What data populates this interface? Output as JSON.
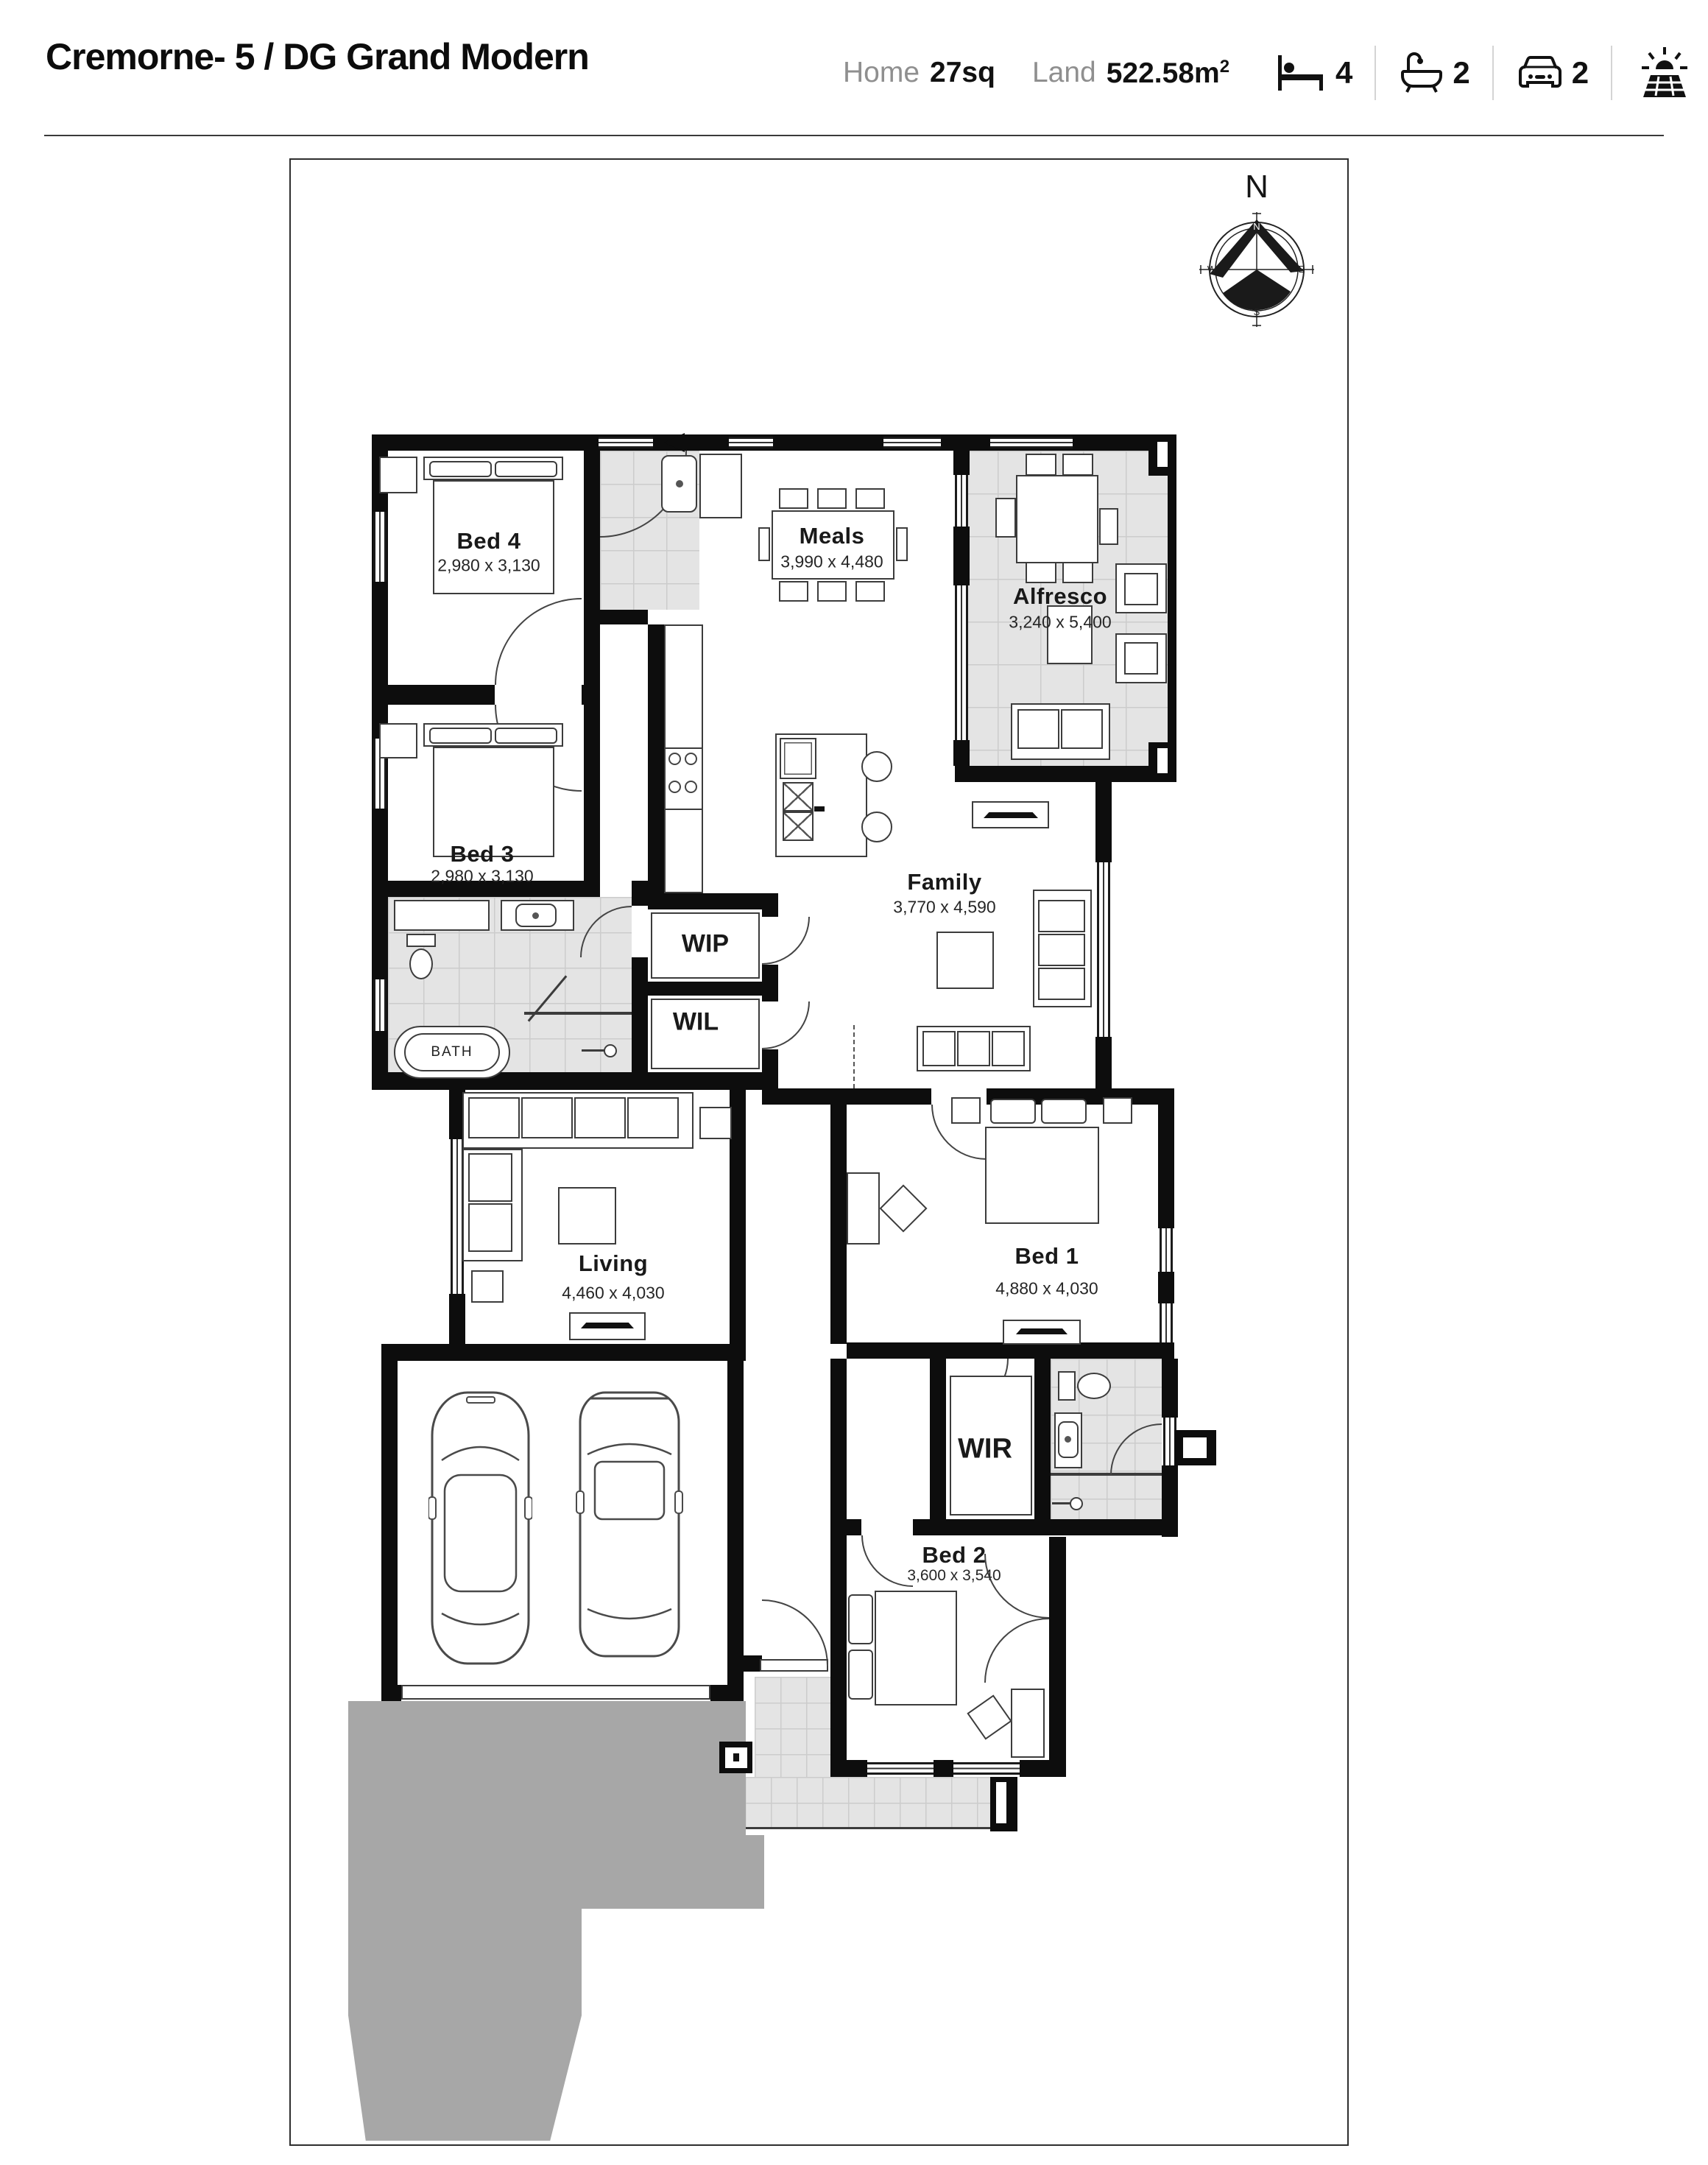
{
  "header": {
    "title": "Cremorne- 5 / DG Grand Modern",
    "home_label": "Home",
    "home_value": "27sq",
    "land_label": "Land",
    "land_value": "522.58m",
    "land_sup": "2",
    "bed_count": "4",
    "bath_count": "2",
    "car_count": "2",
    "icons": {
      "bed": "bed-icon",
      "bath": "bath-icon",
      "car": "car-icon",
      "solar": "solar-panel-icon"
    }
  },
  "compass": {
    "big": "N",
    "n": "N",
    "e": "E",
    "s": "S",
    "w": "W"
  },
  "rooms": {
    "bed4": {
      "name": "Bed 4",
      "dims": "2,980 x 3,130"
    },
    "bed3": {
      "name": "Bed 3",
      "dims": "2,980 x 3,130"
    },
    "meals": {
      "name": "Meals",
      "dims": "3,990 x 4,480"
    },
    "alfresco": {
      "name": "Alfresco",
      "dims": "3,240 x 5,400"
    },
    "family": {
      "name": "Family",
      "dims": "3,770 x 4,590"
    },
    "living": {
      "name": "Living",
      "dims": "4,460 x 4,030"
    },
    "bed1": {
      "name": "Bed 1",
      "dims": "4,880 x 4,030"
    },
    "bed2": {
      "name": "Bed 2",
      "dims": "3,600 x 3,540"
    },
    "wip": {
      "name": "WIP"
    },
    "wil": {
      "name": "WIL"
    },
    "wir": {
      "name": "WIR"
    },
    "bath": {
      "name": "BATH"
    }
  }
}
